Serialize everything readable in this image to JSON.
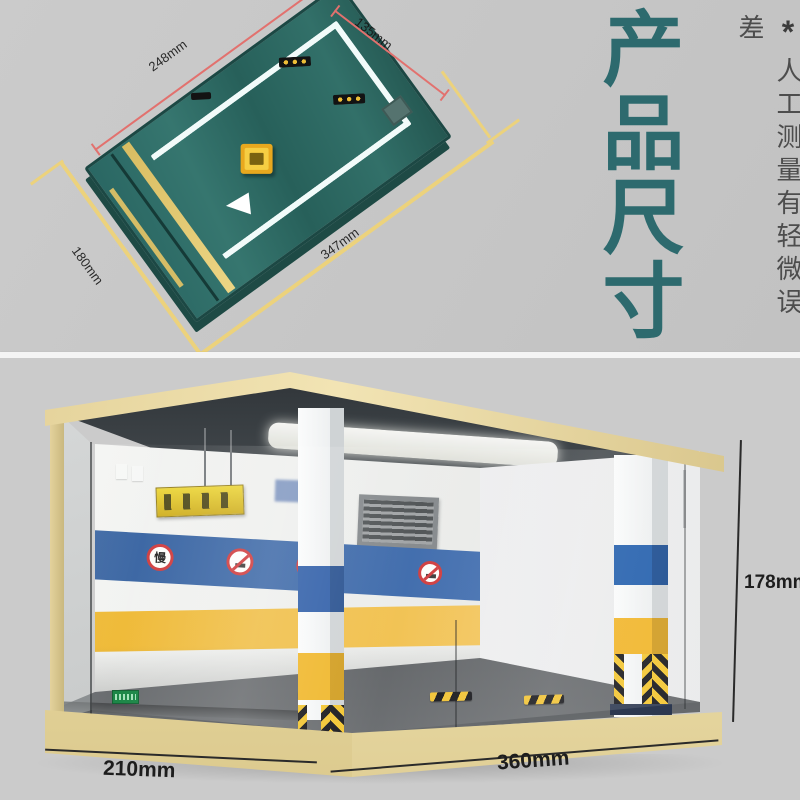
{
  "header": {
    "title": "产品尺寸",
    "note_star": "*",
    "note_text": "人工测量有轻微误差"
  },
  "top_view": {
    "dim_top_edge": "248mm",
    "dim_right_edge": "135mm",
    "dim_left_edge": "180mm",
    "dim_bottom_edge": "347mm"
  },
  "garage": {
    "dim_depth": "210mm",
    "dim_width": "360mm",
    "dim_height": "178mm",
    "sign_slow": "慢",
    "sign_speed_limit": "5"
  },
  "colors": {
    "accent_teal": "#2d6a6e",
    "board_green": "#2e6e6a",
    "dim_red": "#e2716e",
    "dim_yellow": "#ecd27c",
    "stripe_blue": "#35619f",
    "stripe_yellow": "#eeb72e",
    "cream_frame": "#eadca6",
    "hazard_yellow": "#f3c52f"
  }
}
